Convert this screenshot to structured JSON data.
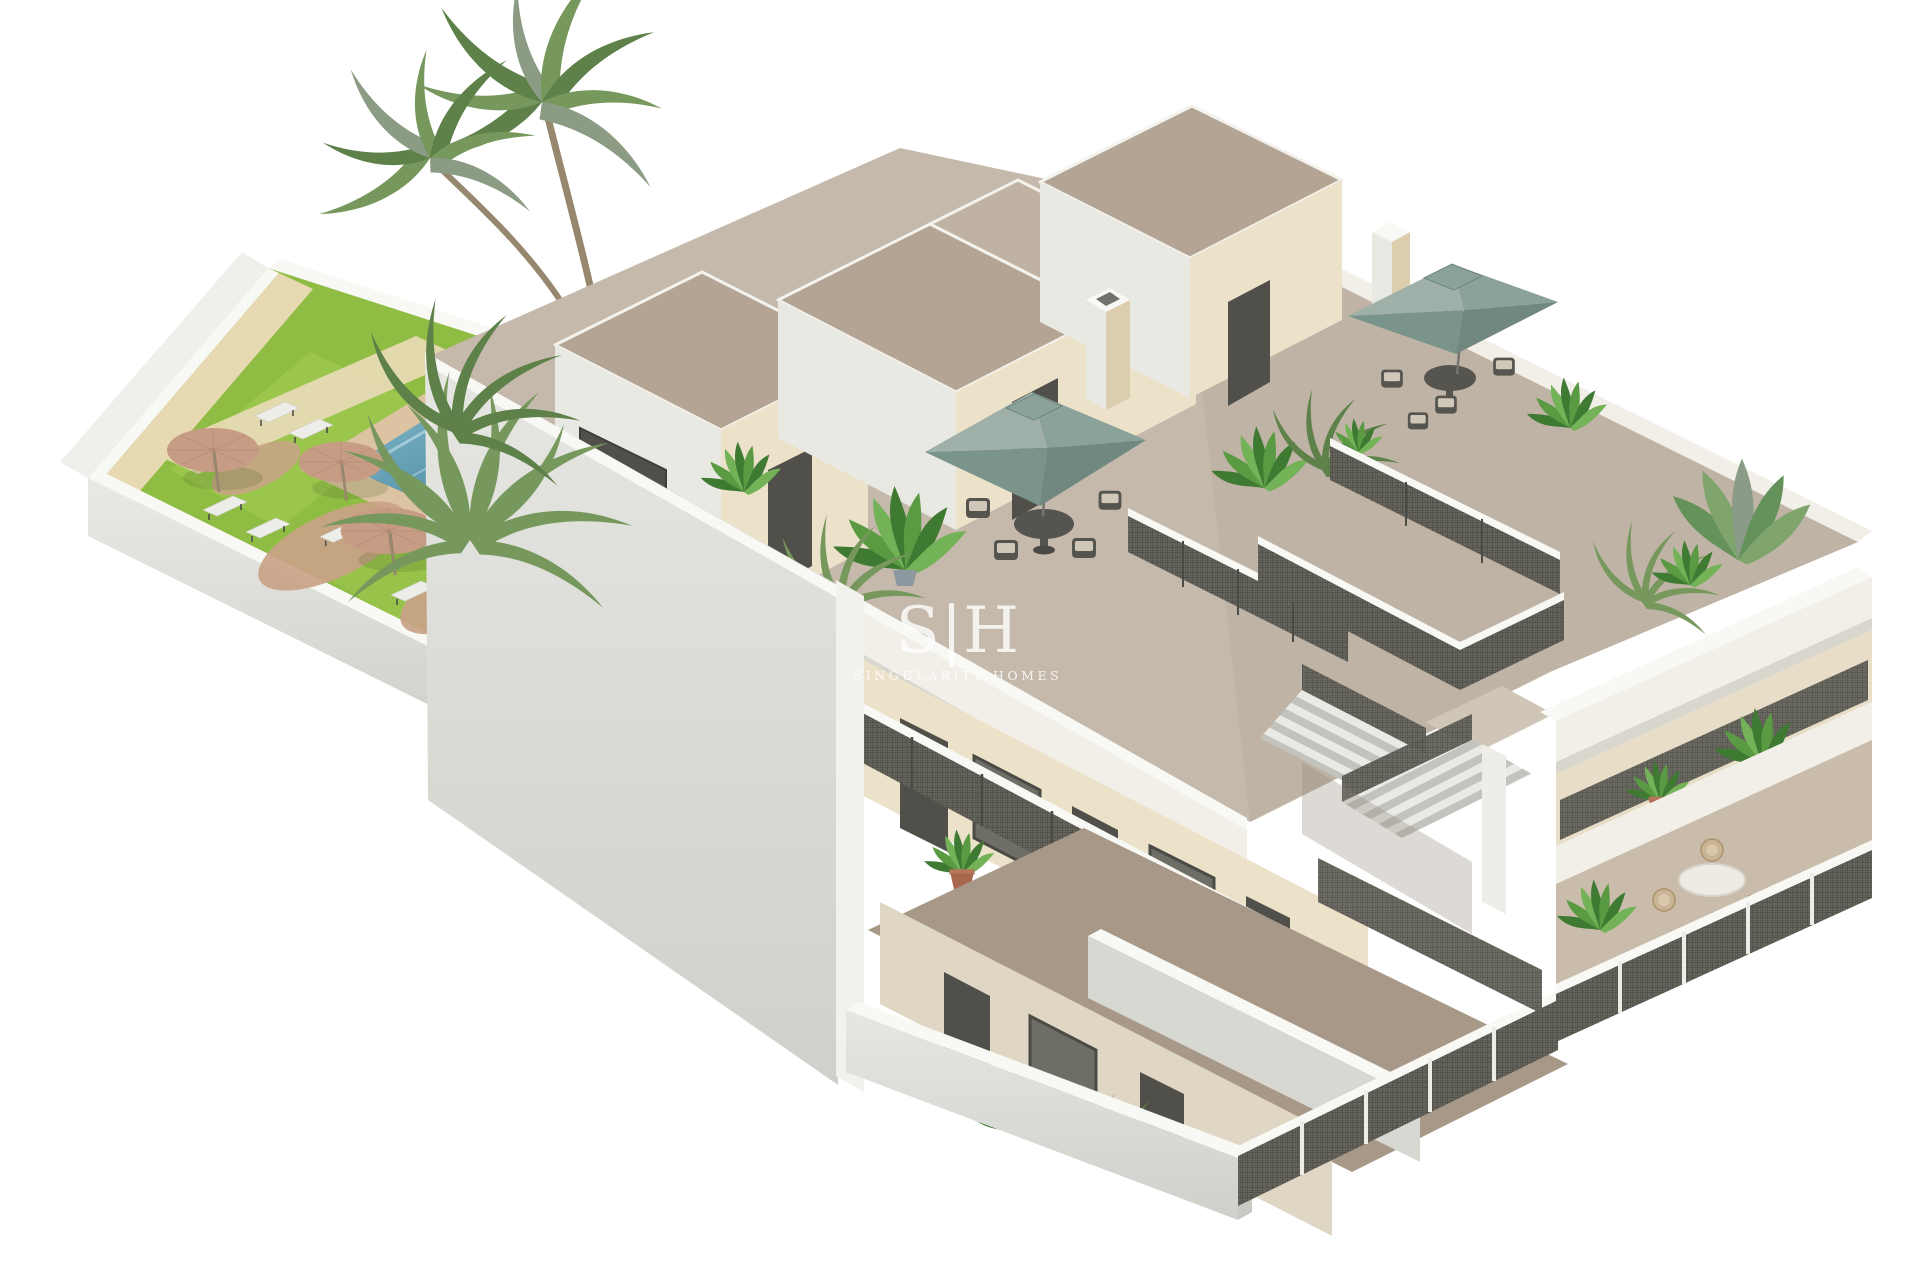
{
  "watermark": {
    "monogram": "S|H",
    "name": "SINGULARITY HOMES"
  },
  "scene": {
    "garden_parasols": 3,
    "roof_umbrellas": 2,
    "palm_trees": 2,
    "sun_loungers": 7,
    "rooftop_stair_boxes": 3,
    "pool": 1
  },
  "colors": {
    "bg": "#FFFFFF",
    "watermark": "#FFFFFF",
    "grass": "#8FBC42",
    "grass-light": "#A4CD55",
    "sand-path": "#E7DAB3",
    "wall-face": "#EFEFEB",
    "coping": "#F8F8F4",
    "pool-deck": "#DCC4A2",
    "pool-sand": "#C9A287",
    "pool-deep": "#3E7E98",
    "pool-light": "#7FB6C8",
    "parasol-tan": "#C69C84",
    "trunk": "#97876F",
    "palm-green-1": "#5E8049",
    "palm-green-2": "#77985D",
    "palm-green-3": "#8C9C84",
    "floor-roof": "#C4B9AB",
    "floor-ground": "#A89888",
    "roof-top": "#B4A494",
    "parapet": "#F1EFE7",
    "wall-lit": "#E9E9E4",
    "wall-shade": "#D6D6D1",
    "cream-lit": "#ECE2CA",
    "cream-shade": "#DCCDAF",
    "door-dark": "#504F4A",
    "glass": "#6E6D66",
    "mesh-base": "#67665F",
    "mesh-line": "#4E4E47",
    "rail-dark": "#55544E",
    "sage": "#8BA29A",
    "sage-light": "#9EB0A7",
    "sage-dark": "#7A948B",
    "sage-dark2": "#70887F",
    "step-light": "#E9E9E5",
    "step-dark": "#C3C3BD",
    "lounger": "#EDEDEA",
    "cushion": "#CFC8B8",
    "pot-terra": "#A8664C",
    "chair-tan": "#C9B594",
    "plant-dark": "#3F7A33",
    "plant-mid": "#5A9A43",
    "plant-light": "#74B258",
    "banana-1": "#64925A",
    "banana-2": "#7FA46C",
    "banana-3": "#8A9C88"
  }
}
